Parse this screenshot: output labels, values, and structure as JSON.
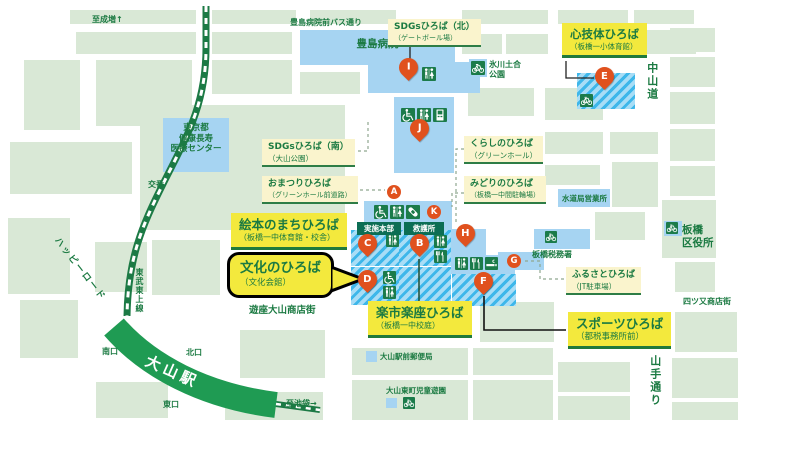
{
  "roads": {
    "to_narimasu": "至成増↑",
    "hospital_bus_street": "豊島病院前バス通り",
    "nakasendo": "中山道",
    "yamate_dori": "山手通り",
    "happy_road": "ハッピーロード",
    "tobu_tojo_line": "東武東上線",
    "to_ikebukuro": "至池袋→",
    "yuza_oyama_shopping_street": "遊座大山商店街",
    "yotsumata_shopping_street": "四ツ又商店街"
  },
  "station": {
    "name": "大山駅",
    "south_exit": "南口",
    "north_exit": "北口",
    "east_exit": "東口"
  },
  "buildings": {
    "toshima_hospital": "豊島病院",
    "medical_center": "東京都\n健康長寿\n医療センター",
    "koban": "交番",
    "hikawa_doai_park": "氷川土合\n公園",
    "waterworks_office": "水道局営業所",
    "tax_office": "板橋税務署",
    "ward_office": "板橋\n区役所",
    "post_office": "大山駅前郵便局",
    "children_park": "大山東町児童遊園"
  },
  "facilities": {
    "hq": "実施本部",
    "first_aid": "救護所"
  },
  "venues": {
    "sdgs_north": {
      "title": "SDGsひろば（北）",
      "sub": "（ゲートボール場）"
    },
    "shingitai": {
      "title": "心技体ひろば",
      "sub": "（板橋一小体育館）"
    },
    "sdgs_south": {
      "title": "SDGsひろば（南）",
      "sub": "（大山公園）"
    },
    "kurashi": {
      "title": "くらしのひろば",
      "sub": "（グリーンホール）"
    },
    "omatsuri": {
      "title": "おまつりひろば",
      "sub": "（グリーンホール前道路）"
    },
    "midori": {
      "title": "みどりのひろば",
      "sub": "（板橋一中間駐輪場）"
    },
    "ehon": {
      "title": "絵本のまちひろば",
      "sub": "（板橋一中体育館・校舎）"
    },
    "bunka": {
      "title": "文化のひろば",
      "sub": "（文化会館）"
    },
    "rakuichi": {
      "title": "楽市楽座ひろば",
      "sub": "（板橋一中校庭）"
    },
    "furusato": {
      "title": "ふるさとひろば",
      "sub": "（JT駐車場）"
    },
    "sports": {
      "title": "スポーツひろば",
      "sub": "（都税事務所前）"
    }
  },
  "markers": {
    "A": "A",
    "B": "B",
    "C": "C",
    "D": "D",
    "E": "E",
    "F": "F",
    "G": "G",
    "H": "H",
    "I": "I",
    "J": "J",
    "K": "K"
  },
  "icons": {
    "toilet": "toilet-icon",
    "wheelchair": "wheelchair-icon",
    "restaurant": "restaurant-icon",
    "smoking": "smoking-icon",
    "bicycle_parking": "bicycle-parking-icon",
    "first_aid": "first-aid-icon",
    "vending": "vending-machine-icon"
  },
  "colors": {
    "venue_highlight": "#f3e93d",
    "venue_pale": "#faf4cd",
    "marker_orange": "#e0511e",
    "station_green": "#1f9b53",
    "block_green": "#d9e8d6",
    "building_blue": "#a6d4f2",
    "text_green": "#1b7a42"
  }
}
